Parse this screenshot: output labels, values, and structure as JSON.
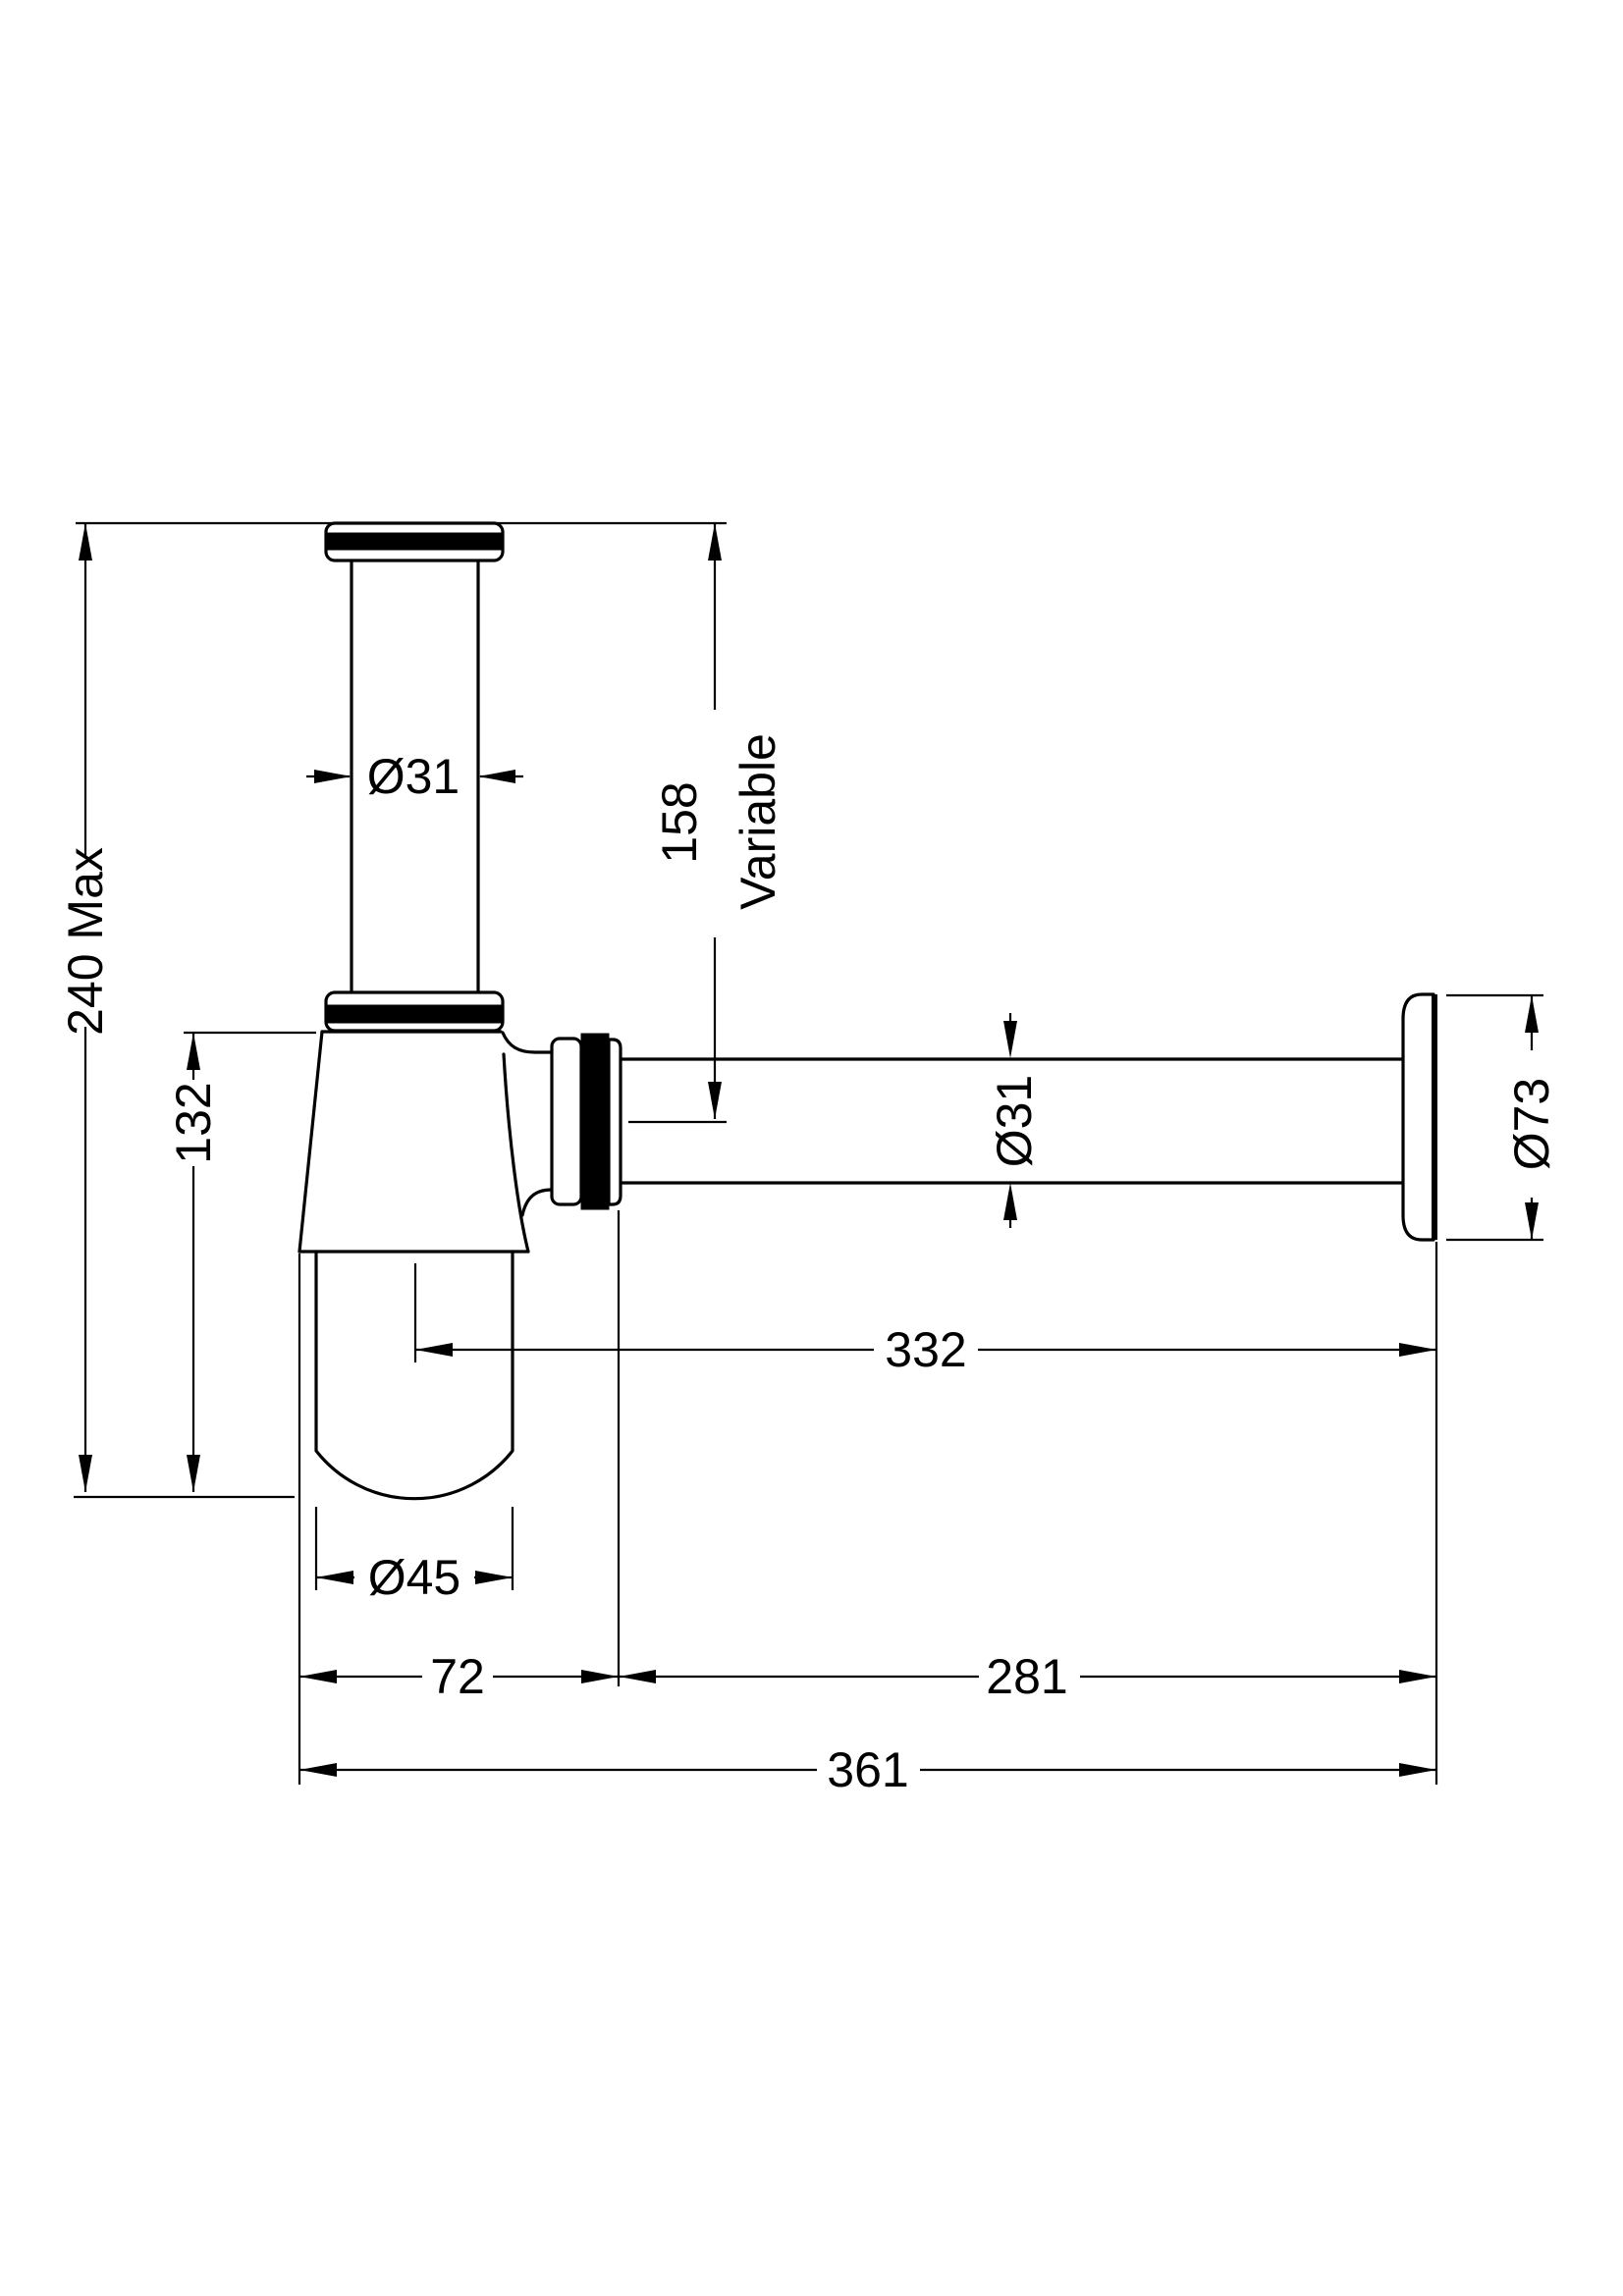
{
  "drawing": {
    "type": "technical-dimension-drawing",
    "subject": "bottle-trap-side-elevation",
    "background_color": "#ffffff",
    "line_color": "#000000",
    "labels": {
      "inlet_diameter": "Ø31",
      "inlet_length": "158",
      "inlet_note": "Variable",
      "max_height": "240 Max",
      "body_height": "132",
      "centre_to_wall": "332",
      "cup_diameter": "Ø45",
      "trap_width": "72",
      "outlet_run": "281",
      "overall_width": "361",
      "outlet_diameter": "Ø31",
      "flange_diameter": "Ø73"
    }
  }
}
